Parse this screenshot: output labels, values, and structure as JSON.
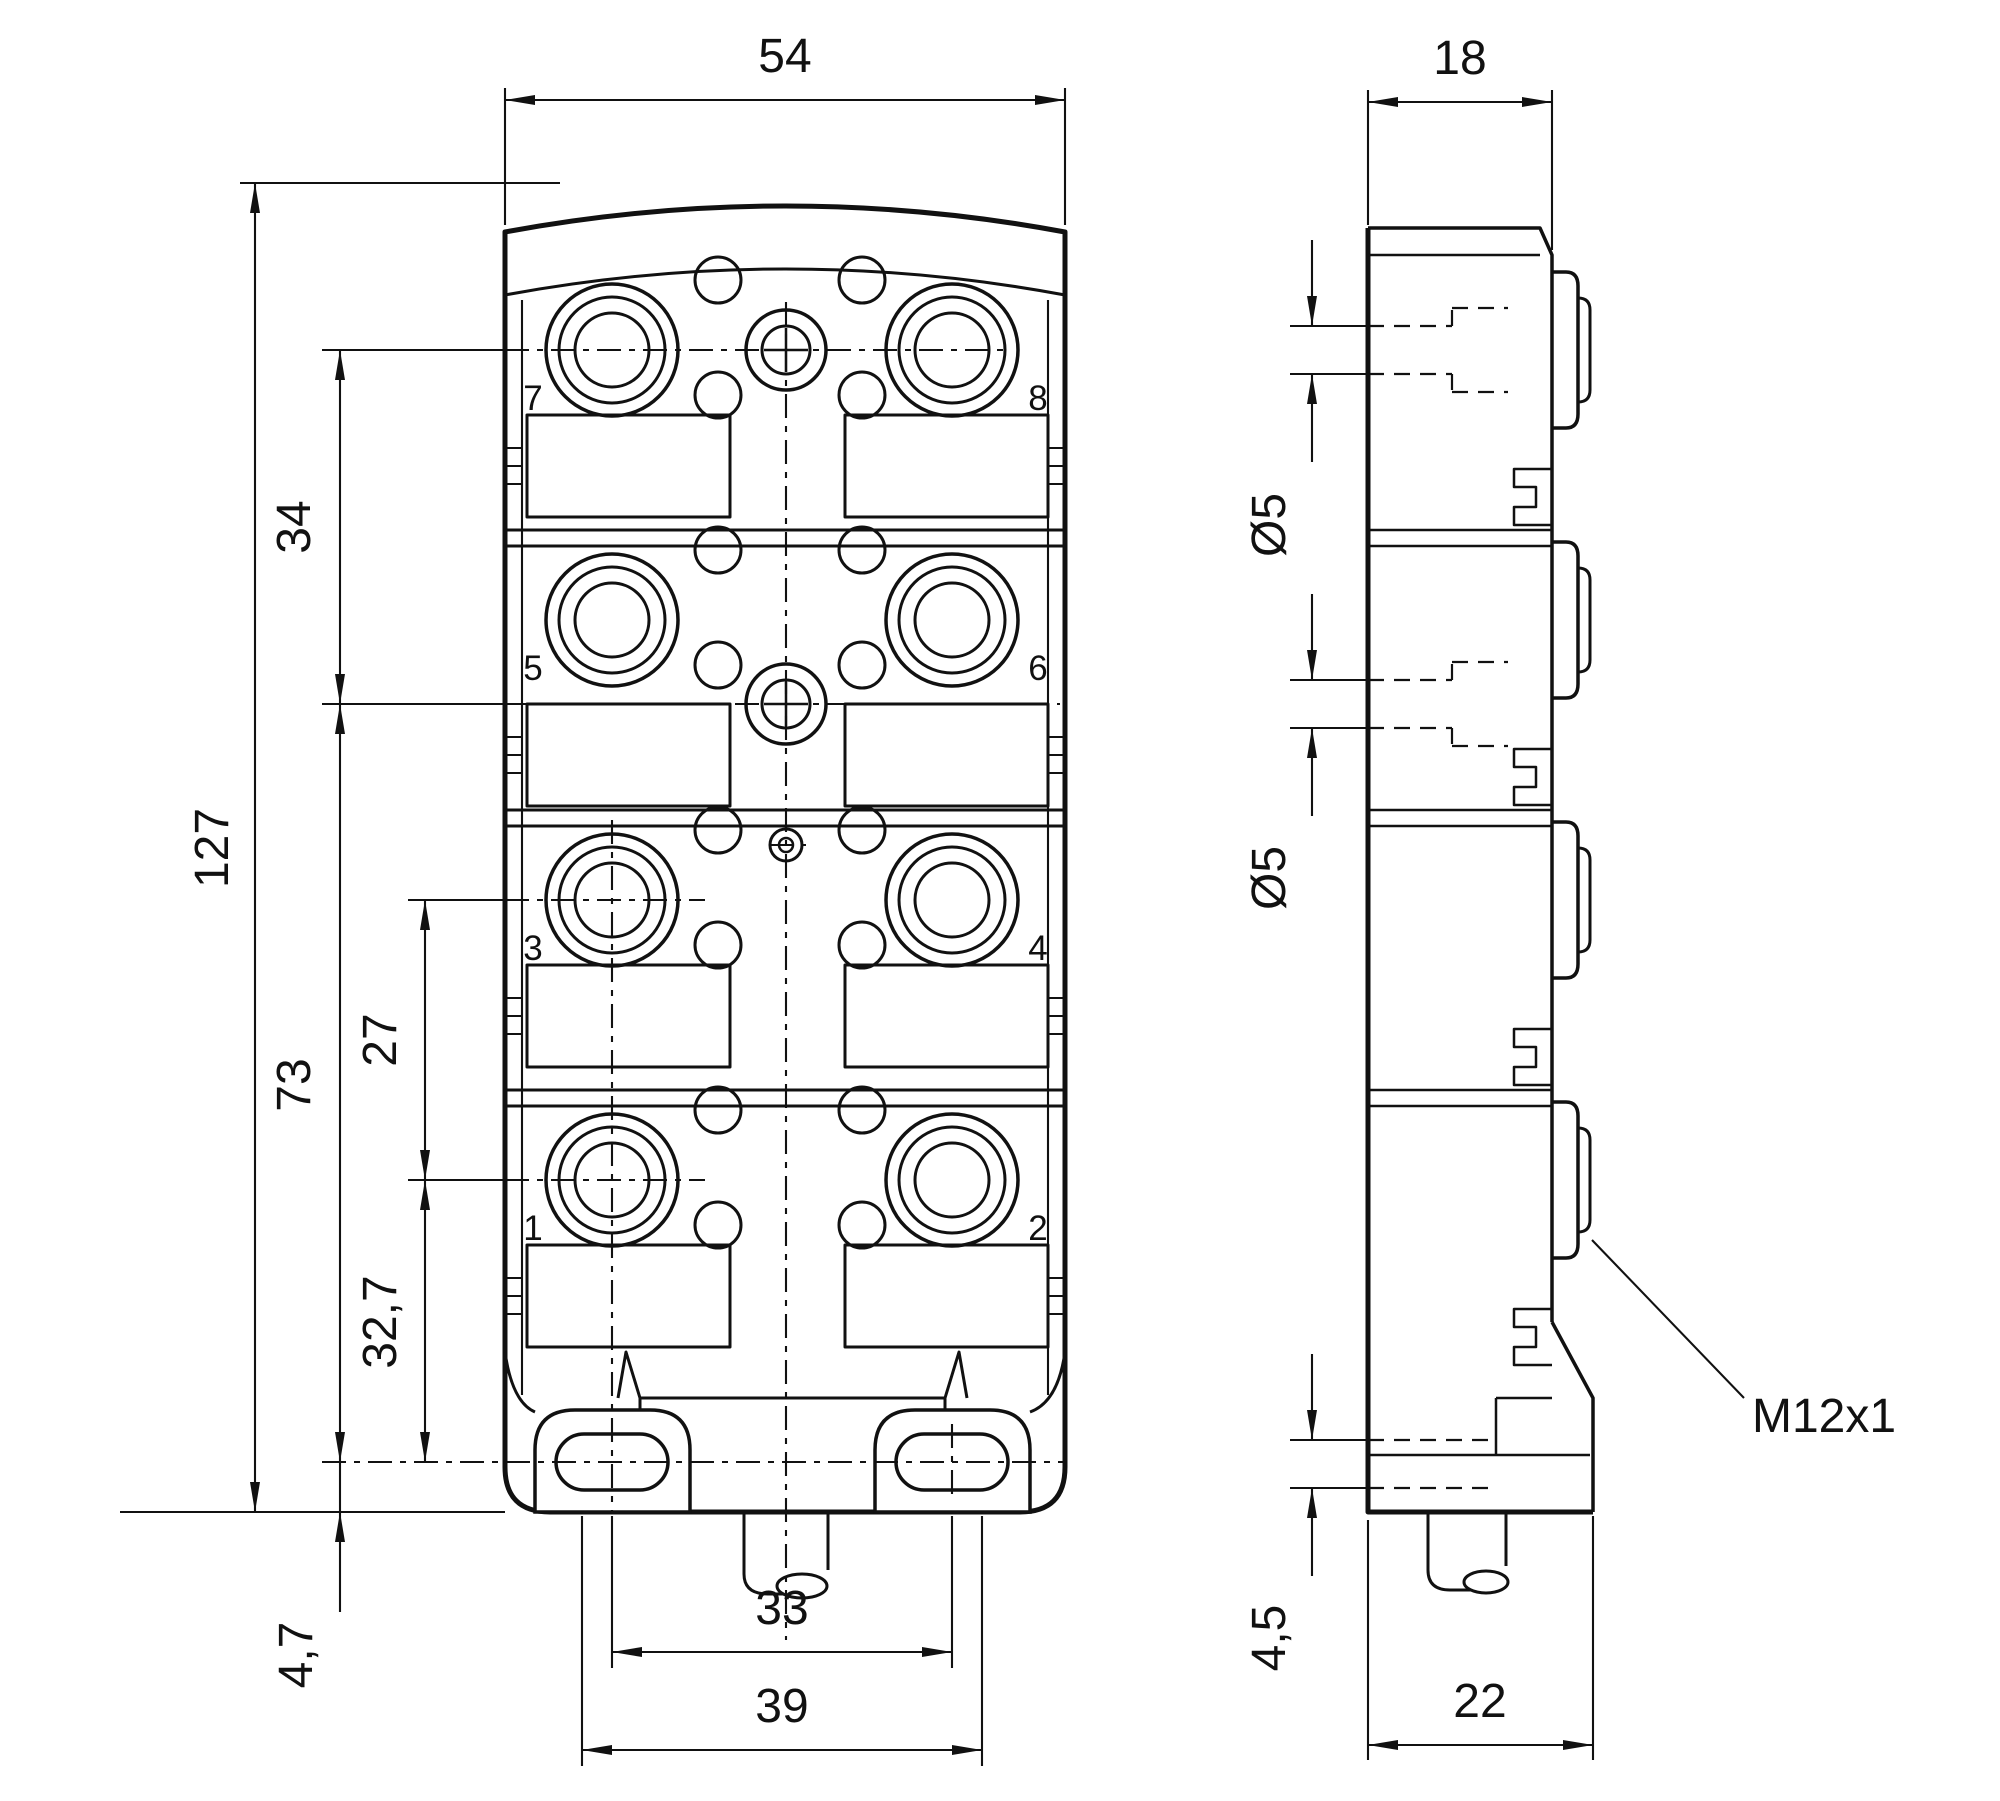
{
  "drawing": {
    "type": "technical-dimension-drawing",
    "subject": "8-port M12 sensor/actuator distribution box, front view and side view",
    "colors": {
      "line": "#111111",
      "background": "#ffffff"
    }
  },
  "front_view": {
    "port_labels": [
      "7",
      "8",
      "5",
      "6",
      "3",
      "4",
      "1",
      "2"
    ],
    "dims": {
      "width": "54",
      "height": "127",
      "top_section": "34",
      "bottom_section": "73",
      "port_spacing": "27",
      "foot_spacing": "32,7",
      "base_offset": "4,7",
      "slot_center_distance": "33",
      "slot_outer_distance": "39"
    }
  },
  "side_view": {
    "dims": {
      "depth": "18",
      "hole_diameter_top": "Ø5",
      "hole_diameter_mid": "Ø5",
      "foot_slot": "4,5",
      "base_depth": "22"
    },
    "connector_thread": "M12x1"
  }
}
